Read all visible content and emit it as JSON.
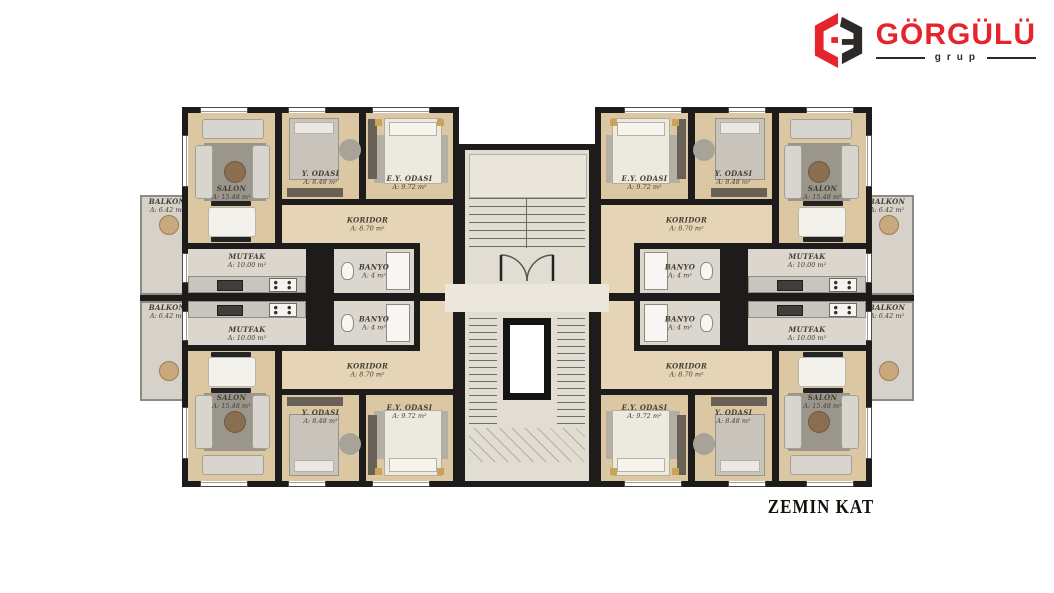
{
  "logo": {
    "brand": "GÖRGÜLÜ",
    "sub": "grup"
  },
  "floor_title": "ZEMIN KAT",
  "rooms": {
    "salon": {
      "name": "SALON",
      "area": "A: 15.48 m²"
    },
    "y_odasi": {
      "name": "Y. ODASI",
      "area": "A: 8.48 m²"
    },
    "ey_odasi": {
      "name": "E.Y. ODASI",
      "area": "A: 9.72 m²"
    },
    "koridor": {
      "name": "KORIDOR",
      "area": "A: 8.70 m²"
    },
    "mutfak": {
      "name": "MUTFAK",
      "area": "A: 10.00 m²"
    },
    "banyo": {
      "name": "BANYO",
      "area": "A: 4 m²"
    },
    "balkon": {
      "name": "BALKON",
      "area": "A: 6.42 m²"
    }
  },
  "colors": {
    "brand_red": "#e5252b",
    "wall": "#1d1c1a",
    "wood": "#dcc7a3",
    "tile": "#dbd7cf"
  }
}
